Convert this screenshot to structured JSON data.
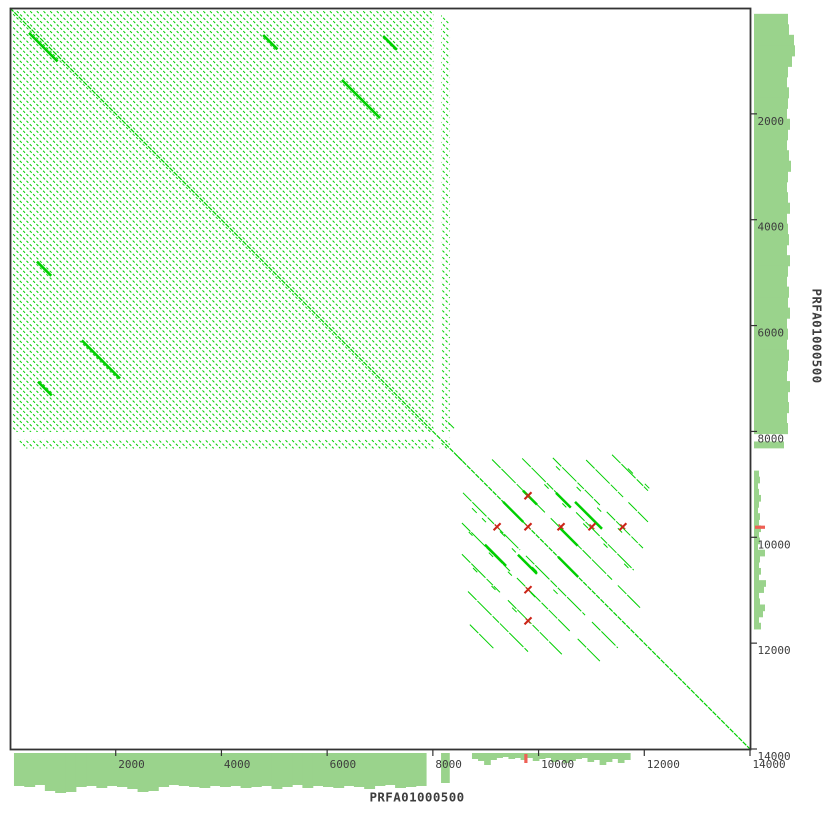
{
  "figure": {
    "width_px": 830,
    "height_px": 830,
    "background": "#ffffff"
  },
  "axis_labels": {
    "x": "PRFA01000500",
    "y": "PRFA01000500"
  },
  "chart_data": {
    "type": "scatter",
    "variant": "sequence-self-dotplot",
    "title": "",
    "xlabel": "PRFA01000500",
    "ylabel": "PRFA01000500",
    "x_axis": {
      "label": "PRFA01000500",
      "range": [
        0,
        14000
      ],
      "ticks": [
        2000,
        4000,
        6000,
        8000,
        10000,
        12000,
        14000
      ]
    },
    "y_axis": {
      "label": "PRFA01000500",
      "range": [
        0,
        14000
      ],
      "ticks": [
        2000,
        4000,
        6000,
        8000,
        10000,
        12000,
        14000
      ]
    },
    "grid": false,
    "legend": false,
    "layout": {
      "plot_px": {
        "left": 10,
        "top": 8,
        "right": 750,
        "bottom": 749
      },
      "tick_len_px": 7,
      "track_offset_px": 3,
      "track_max_px": 41
    },
    "colors": {
      "match_green": "#00cf00",
      "track_green": "#9ad38c",
      "reverse_red": "#cc2418",
      "track_red": "#ee6055",
      "axis": "#333333",
      "text": "#3d3d3d",
      "background": "#ffffff"
    },
    "main_diagonal": {
      "start_bp": 0,
      "end_bp": 14000,
      "bold_segments": [
        [
          9330,
          9330,
          380
        ],
        [
          10370,
          10370,
          380
        ]
      ]
    },
    "regions": {
      "repeat_block_a": {
        "comment": "dense tandem-repeat block, forward diagonals",
        "start_bp": 60,
        "end_bp": 8320,
        "core_end_bp": 8010,
        "gap_end_bp": 8155,
        "span": 8260,
        "period_bp": 126,
        "bold_segments": [
          [
            360,
            470,
            540
          ],
          [
            4790,
            510,
            270
          ],
          [
            510,
            4790,
            270
          ],
          [
            6280,
            1360,
            720
          ],
          [
            1360,
            6280,
            720
          ],
          [
            530,
            7060,
            260
          ],
          [
            7060,
            530,
            260
          ]
        ]
      },
      "repeat_block_b": {
        "comment": "sparser repeat cluster, period ~590 bp",
        "start_bp": 8450,
        "end_bp": 12150,
        "period_bp": 590,
        "lines": [
          {
            "offset_bp": -2950,
            "segments": [
              [
                11390,
                12070
              ]
            ]
          },
          {
            "offset_bp": -2360,
            "segments": [
              [
                10900,
                11600
              ],
              [
                11700,
                12070
              ]
            ]
          },
          {
            "offset_bp": -1770,
            "segments": [
              [
                10270,
                11160
              ],
              [
                11290,
                11975
              ]
            ]
          },
          {
            "offset_bp": -1180,
            "segments": [
              [
                9690,
                10590
              ],
              [
                10710,
                11800
              ]
            ]
          },
          {
            "offset_bp": -590,
            "segments": [
              [
                9120,
                10120
              ],
              [
                10230,
                11390
              ],
              [
                11500,
                11920
              ]
            ]
          },
          {
            "offset_bp": 590,
            "segments": [
              [
                8570,
                9650
              ],
              [
                9760,
                10880
              ],
              [
                11010,
                11500
              ]
            ]
          },
          {
            "offset_bp": 1180,
            "segments": [
              [
                8550,
                9460
              ],
              [
                9590,
                10590
              ],
              [
                10740,
                11160
              ]
            ]
          },
          {
            "offset_bp": 1770,
            "segments": [
              [
                8550,
                9270
              ],
              [
                9420,
                10440
              ]
            ]
          },
          {
            "offset_bp": 2360,
            "segments": [
              [
                8665,
                9800
              ]
            ]
          },
          {
            "offset_bp": 2950,
            "segments": [
              [
                8700,
                9150
              ]
            ]
          }
        ],
        "bold_segments": [
          [
            9705,
            9118,
            265
          ],
          [
            10330,
            9160,
            280
          ],
          [
            10400,
            9820,
            340
          ],
          [
            9610,
            10330,
            360
          ],
          [
            8985,
            10140,
            400
          ],
          [
            10690,
            9330,
            510
          ]
        ],
        "fragments": [
          [
            8740,
            9450,
            90
          ],
          [
            8930,
            9640,
            75
          ],
          [
            9270,
            9890,
            95
          ],
          [
            9495,
            10210,
            75
          ],
          [
            9880,
            10560,
            90
          ],
          [
            10280,
            10990,
            80
          ],
          [
            8680,
            9900,
            70
          ],
          [
            9060,
            10290,
            80
          ],
          [
            9420,
            10650,
            75
          ],
          [
            9845,
            11040,
            90
          ],
          [
            8760,
            10580,
            80
          ],
          [
            9110,
            10920,
            75
          ],
          [
            9500,
            11330,
            85
          ],
          [
            10110,
            9000,
            80
          ],
          [
            10450,
            9360,
            75
          ],
          [
            10845,
            9740,
            90
          ],
          [
            11230,
            10120,
            75
          ],
          [
            11620,
            10500,
            80
          ],
          [
            10330,
            8660,
            75
          ],
          [
            10720,
            9050,
            80
          ],
          [
            11110,
            9440,
            75
          ],
          [
            11500,
            9830,
            80
          ],
          [
            11690,
            8700,
            95
          ],
          [
            12010,
            8990,
            85
          ],
          [
            8290,
            7830,
            110
          ],
          [
            8440,
            8440,
            120
          ]
        ]
      }
    },
    "inverted_repeat_marks": {
      "comment": "red X marks = reverse-complement matches around 9800 bp",
      "points": [
        [
          9215,
          9800
        ],
        [
          9800,
          9800
        ],
        [
          10425,
          9800
        ],
        [
          11010,
          9800
        ],
        [
          11595,
          9800
        ],
        [
          9800,
          9215
        ],
        [
          9800,
          10990
        ],
        [
          9800,
          11580
        ]
      ]
    },
    "margin_tracks": {
      "bottom": {
        "band_a": {
          "start_bp": 75,
          "end_bp": 7870,
          "heights_px": [
            33,
            34,
            32,
            38,
            40,
            39,
            34,
            33,
            35,
            33,
            34,
            36,
            39,
            38,
            34,
            32,
            33,
            34,
            35,
            33,
            34,
            33,
            35,
            34,
            33,
            36,
            34,
            32,
            35,
            33,
            34,
            35,
            33,
            34,
            36,
            33,
            32,
            35,
            34,
            33
          ]
        },
        "strip": {
          "start_bp": 8155,
          "end_bp": 8320,
          "height_px": 30
        },
        "band_b": {
          "start_bp": 8740,
          "end_bp": 11730,
          "heights_px": [
            6,
            8,
            12,
            7,
            5,
            4,
            6,
            5,
            7,
            5,
            8,
            6,
            5,
            9,
            7,
            10,
            8,
            6,
            5,
            9,
            7,
            12,
            9,
            6,
            10,
            7
          ]
        },
        "red_tick_bp": 9760
      },
      "right": {
        "band_a": {
          "start_bp": 110,
          "end_bp": 8040,
          "heights_px": [
            34,
            35,
            40,
            41,
            38,
            34,
            33,
            35,
            34,
            33,
            36,
            34,
            33,
            35,
            37,
            34,
            33,
            34,
            36,
            33,
            34,
            35,
            33,
            36,
            34,
            33,
            35,
            34,
            36,
            33,
            34,
            33,
            35,
            34,
            33,
            36,
            34,
            35,
            33,
            34
          ]
        },
        "strip": {
          "start_bp": 8190,
          "end_bp": 8320,
          "height_px": 30
        },
        "band_b": {
          "start_bp": 8740,
          "end_bp": 11730,
          "heights_px": [
            5,
            6,
            4,
            5,
            7,
            5,
            4,
            6,
            5,
            7,
            5,
            6,
            4,
            11,
            6,
            5,
            7,
            5,
            12,
            10,
            5,
            6,
            11,
            9,
            5,
            7
          ]
        },
        "red_tick_bp": 9810
      }
    }
  }
}
